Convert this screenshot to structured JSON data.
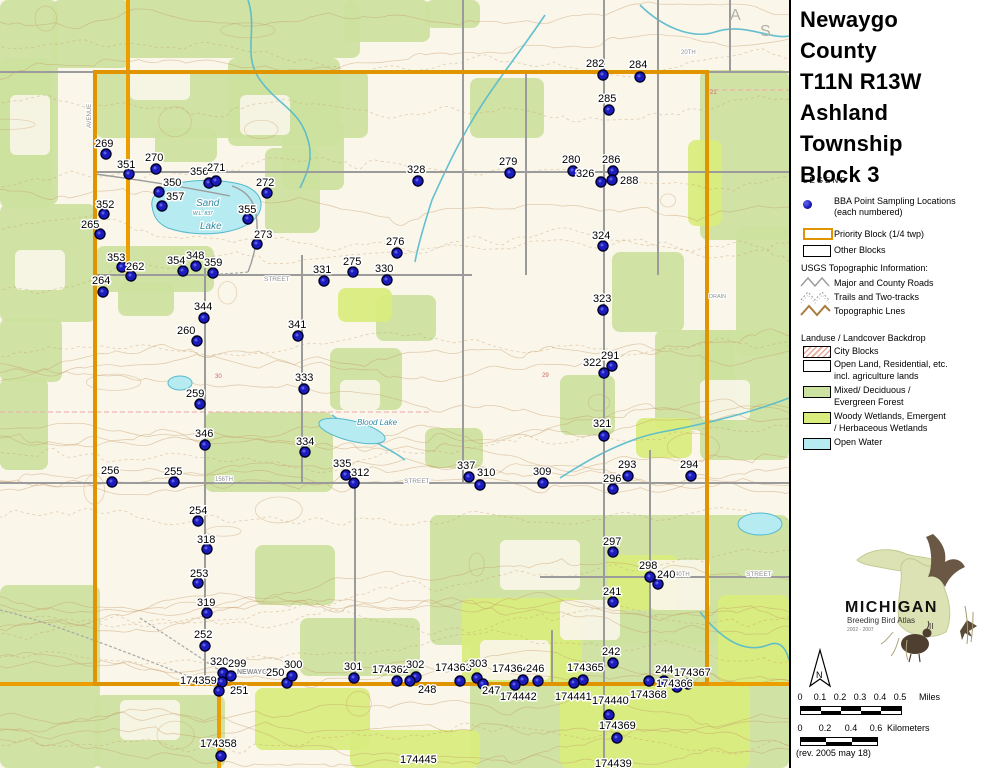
{
  "panel": {
    "title": "Newaygo\nCounty\nT11N R13W\nAshland\nTownship\nBlock 3",
    "legend_heading": "LEGEND",
    "legend": {
      "bba_line1": "BBA Point Sampling Locations",
      "bba_line2": "(each numbered)",
      "priority": "Priority Block (1/4 twp)",
      "other": "Other Blocks",
      "usgs_heading": "USGS Topographic Information:",
      "roads": "Major and County Roads",
      "trails": "Trails and Two-tracks",
      "topo": "Topographic Lnes",
      "landuse_heading": "Landuse / Landcover Backdrop",
      "city": "City Blocks",
      "open1": "Open Land, Residential, etc.",
      "open2": "incl. agriculture lands",
      "mixed1": "Mixed/ Deciduous /",
      "mixed2": "Evergreen Forest",
      "woody1": "Woody Wetlands, Emergent",
      "woody2": "/ Herbaceous Wetlands",
      "water": "Open Water"
    },
    "logo": {
      "name": "MICHIGAN",
      "subtitle": "Breeding Bird Atlas",
      "years": "2002 - 2007",
      "numeral": "II"
    },
    "north_label": "N",
    "scale_miles": {
      "labels": [
        "0",
        "0.1",
        "0.2",
        "0.3",
        "0.4",
        "0.5"
      ],
      "unit": "Miles"
    },
    "scale_km": {
      "labels": [
        "0",
        "0.2",
        "0.4",
        "0.6"
      ],
      "unit": "Kilometers"
    },
    "revision": "(rev. 2005 may 18)"
  },
  "colors": {
    "priority": "#df9400",
    "highway": "#ec9e00",
    "road": "#9b9b9b",
    "contour": "#c59a66",
    "forest": "#cde2a0",
    "wetland": "#d9ec7e",
    "water": "#b7ebf2",
    "water_edge": "#54b9cc",
    "dot_fill": "#1c1cbe",
    "dot_rim": "#00002a",
    "section_pink": "#eba8a8",
    "base": "#faf6ea"
  },
  "map": {
    "points": [
      {
        "n": "269",
        "x": 106,
        "y": 154,
        "lx": 95,
        "ly": 137
      },
      {
        "n": "351",
        "x": 129,
        "y": 174,
        "lx": 117,
        "ly": 158
      },
      {
        "n": "270",
        "x": 156,
        "y": 169,
        "lx": 145,
        "ly": 151
      },
      {
        "n": "356",
        "x": 209,
        "y": 183,
        "lx": 190,
        "ly": 165
      },
      {
        "n": "271",
        "x": 216,
        "y": 181,
        "lx": 207,
        "ly": 161
      },
      {
        "n": "272",
        "x": 267,
        "y": 193,
        "lx": 256,
        "ly": 176
      },
      {
        "n": "350",
        "x": 159,
        "y": 192,
        "lx": 163,
        "ly": 176
      },
      {
        "n": "357",
        "x": 162,
        "y": 206,
        "lx": 166,
        "ly": 190
      },
      {
        "n": "352",
        "x": 104,
        "y": 214,
        "lx": 96,
        "ly": 198
      },
      {
        "n": "265",
        "x": 100,
        "y": 234,
        "lx": 81,
        "ly": 218
      },
      {
        "n": "355",
        "x": 248,
        "y": 219,
        "lx": 238,
        "ly": 203
      },
      {
        "n": "273",
        "x": 257,
        "y": 244,
        "lx": 254,
        "ly": 228
      },
      {
        "n": "353",
        "x": 122,
        "y": 267,
        "lx": 107,
        "ly": 251
      },
      {
        "n": "262",
        "x": 131,
        "y": 276,
        "lx": 126,
        "ly": 260
      },
      {
        "n": "354",
        "x": 183,
        "y": 271,
        "lx": 167,
        "ly": 254
      },
      {
        "n": "348",
        "x": 196,
        "y": 266,
        "lx": 186,
        "ly": 249
      },
      {
        "n": "359",
        "x": 213,
        "y": 273,
        "lx": 204,
        "ly": 256
      },
      {
        "n": "264",
        "x": 103,
        "y": 292,
        "lx": 92,
        "ly": 274
      },
      {
        "n": "282",
        "x": 603,
        "y": 75,
        "lx": 586,
        "ly": 57
      },
      {
        "n": "284",
        "x": 640,
        "y": 77,
        "lx": 629,
        "ly": 58
      },
      {
        "n": "285",
        "x": 609,
        "y": 110,
        "lx": 598,
        "ly": 92
      },
      {
        "n": "279",
        "x": 510,
        "y": 173,
        "lx": 499,
        "ly": 155
      },
      {
        "n": "280",
        "x": 573,
        "y": 171,
        "lx": 562,
        "ly": 153
      },
      {
        "n": "286",
        "x": 613,
        "y": 171,
        "lx": 602,
        "ly": 153
      },
      {
        "n": "326",
        "x": 601,
        "y": 182,
        "lx": 576,
        "ly": 167
      },
      {
        "n": "288",
        "x": 612,
        "y": 180,
        "lx": 620,
        "ly": 174
      },
      {
        "n": "328",
        "x": 418,
        "y": 181,
        "lx": 407,
        "ly": 163
      },
      {
        "n": "324",
        "x": 603,
        "y": 246,
        "lx": 592,
        "ly": 229
      },
      {
        "n": "276",
        "x": 397,
        "y": 253,
        "lx": 386,
        "ly": 235
      },
      {
        "n": "331",
        "x": 324,
        "y": 281,
        "lx": 313,
        "ly": 263
      },
      {
        "n": "275",
        "x": 353,
        "y": 272,
        "lx": 343,
        "ly": 255
      },
      {
        "n": "330",
        "x": 387,
        "y": 280,
        "lx": 375,
        "ly": 262
      },
      {
        "n": "344",
        "x": 204,
        "y": 318,
        "lx": 194,
        "ly": 300
      },
      {
        "n": "260",
        "x": 197,
        "y": 341,
        "lx": 177,
        "ly": 324
      },
      {
        "n": "341",
        "x": 298,
        "y": 336,
        "lx": 288,
        "ly": 318
      },
      {
        "n": "323",
        "x": 603,
        "y": 310,
        "lx": 593,
        "ly": 292
      },
      {
        "n": "322",
        "x": 604,
        "y": 373,
        "lx": 583,
        "ly": 356
      },
      {
        "n": "291",
        "x": 612,
        "y": 366,
        "lx": 601,
        "ly": 349
      },
      {
        "n": "333",
        "x": 304,
        "y": 389,
        "lx": 295,
        "ly": 371
      },
      {
        "n": "259",
        "x": 200,
        "y": 404,
        "lx": 186,
        "ly": 387
      },
      {
        "n": "321",
        "x": 604,
        "y": 436,
        "lx": 593,
        "ly": 417
      },
      {
        "n": "346",
        "x": 205,
        "y": 445,
        "lx": 195,
        "ly": 427
      },
      {
        "n": "334",
        "x": 305,
        "y": 452,
        "lx": 296,
        "ly": 435
      },
      {
        "n": "256",
        "x": 112,
        "y": 482,
        "lx": 101,
        "ly": 464
      },
      {
        "n": "255",
        "x": 174,
        "y": 482,
        "lx": 164,
        "ly": 465
      },
      {
        "n": "335",
        "x": 346,
        "y": 475,
        "lx": 333,
        "ly": 457
      },
      {
        "n": "312",
        "x": 354,
        "y": 483,
        "lx": 351,
        "ly": 466
      },
      {
        "n": "337",
        "x": 469,
        "y": 477,
        "lx": 457,
        "ly": 459
      },
      {
        "n": "310",
        "x": 480,
        "y": 485,
        "lx": 477,
        "ly": 466
      },
      {
        "n": "309",
        "x": 543,
        "y": 483,
        "lx": 533,
        "ly": 465
      },
      {
        "n": "293",
        "x": 628,
        "y": 476,
        "lx": 618,
        "ly": 458
      },
      {
        "n": "296",
        "x": 613,
        "y": 489,
        "lx": 603,
        "ly": 472
      },
      {
        "n": "294",
        "x": 691,
        "y": 476,
        "lx": 680,
        "ly": 458
      },
      {
        "n": "254",
        "x": 198,
        "y": 521,
        "lx": 189,
        "ly": 504
      },
      {
        "n": "318",
        "x": 207,
        "y": 549,
        "lx": 197,
        "ly": 533
      },
      {
        "n": "253",
        "x": 198,
        "y": 583,
        "lx": 190,
        "ly": 567
      },
      {
        "n": "319",
        "x": 207,
        "y": 613,
        "lx": 197,
        "ly": 596
      },
      {
        "n": "297",
        "x": 613,
        "y": 552,
        "lx": 603,
        "ly": 535
      },
      {
        "n": "298",
        "x": 650,
        "y": 577,
        "lx": 639,
        "ly": 559
      },
      {
        "n": "240",
        "x": 658,
        "y": 584,
        "lx": 657,
        "ly": 568
      },
      {
        "n": "241",
        "x": 613,
        "y": 602,
        "lx": 603,
        "ly": 585
      },
      {
        "n": "252",
        "x": 205,
        "y": 646,
        "lx": 194,
        "ly": 628
      },
      {
        "n": "320",
        "x": 223,
        "y": 673,
        "lx": 210,
        "ly": 655
      },
      {
        "n": "299",
        "x": 231,
        "y": 676,
        "lx": 228,
        "ly": 657
      },
      {
        "n": "174359",
        "x": 222,
        "y": 682,
        "lx": 180,
        "ly": 674
      },
      {
        "n": "251",
        "x": 219,
        "y": 691,
        "lx": 230,
        "ly": 684
      },
      {
        "n": "250",
        "x": 287,
        "y": 683,
        "lx": 266,
        "ly": 666
      },
      {
        "n": "300",
        "x": 292,
        "y": 676,
        "lx": 284,
        "ly": 658
      },
      {
        "n": "301",
        "x": 354,
        "y": 678,
        "lx": 344,
        "ly": 660
      },
      {
        "n": "174362",
        "x": 397,
        "y": 681,
        "lx": 372,
        "ly": 663
      },
      {
        "n": "302",
        "x": 416,
        "y": 677,
        "lx": 406,
        "ly": 658
      },
      {
        "n": "248",
        "x": 410,
        "y": 681,
        "lx": 418,
        "ly": 683
      },
      {
        "n": "174363",
        "x": 460,
        "y": 681,
        "lx": 435,
        "ly": 661
      },
      {
        "n": "303",
        "x": 477,
        "y": 678,
        "lx": 469,
        "ly": 657
      },
      {
        "n": "247",
        "x": 483,
        "y": 684,
        "lx": 482,
        "ly": 684
      },
      {
        "n": "174364",
        "x": 523,
        "y": 680,
        "lx": 492,
        "ly": 662
      },
      {
        "n": "246",
        "x": 538,
        "y": 681,
        "lx": 526,
        "ly": 662
      },
      {
        "n": "174442",
        "x": 515,
        "y": 685,
        "lx": 500,
        "ly": 690
      },
      {
        "n": "174365",
        "x": 583,
        "y": 680,
        "lx": 567,
        "ly": 661
      },
      {
        "n": "174441",
        "x": 574,
        "y": 683,
        "lx": 555,
        "ly": 690
      },
      {
        "n": "242",
        "x": 613,
        "y": 663,
        "lx": 602,
        "ly": 645
      },
      {
        "n": "174440",
        "x": 609,
        "y": 715,
        "lx": 592,
        "ly": 694
      },
      {
        "n": "174369",
        "x": 617,
        "y": 738,
        "lx": 599,
        "ly": 719
      },
      {
        "n": "244",
        "x": 649,
        "y": 681,
        "lx": 655,
        "ly": 663
      },
      {
        "n": "174367",
        "x": 664,
        "y": 681,
        "lx": 674,
        "ly": 666
      },
      {
        "n": "174366",
        "x": 688,
        "y": 684,
        "lx": 656,
        "ly": 677
      },
      {
        "n": "174368",
        "x": 677,
        "y": 687,
        "lx": 630,
        "ly": 688
      },
      {
        "n": "174358",
        "x": 221,
        "y": 756,
        "lx": 200,
        "ly": 737
      },
      {
        "n": "174445",
        "lx": 400,
        "ly": 753,
        "nodot": true
      },
      {
        "n": "174439",
        "lx": 595,
        "ly": 757,
        "nodot": true
      }
    ],
    "street_labels": [
      {
        "t": "NEWAYGO",
        "x": 237,
        "y": 674,
        "s": 7,
        "b": 1
      },
      {
        "t": "STREET",
        "x": 264,
        "y": 281,
        "s": 6.5
      },
      {
        "t": "STREET",
        "x": 404,
        "y": 483,
        "s": 6.5
      },
      {
        "t": "156TH",
        "x": 215,
        "y": 481,
        "s": 6
      },
      {
        "t": "STREET",
        "x": 746,
        "y": 576,
        "s": 6.5
      },
      {
        "t": "40TH",
        "x": 675,
        "y": 576,
        "s": 6
      },
      {
        "t": "20TH",
        "x": 681,
        "y": 54,
        "s": 6
      },
      {
        "t": "DRAIN",
        "x": 709,
        "y": 298,
        "s": 5.5
      },
      {
        "t": "AVENUE",
        "x": 91,
        "y": 128,
        "s": 6,
        "rot": -90
      }
    ],
    "water_labels": [
      {
        "t": "Sand",
        "x": 196,
        "y": 206,
        "s": 10
      },
      {
        "t": "W.L. 837",
        "x": 193,
        "y": 215,
        "s": 5
      },
      {
        "t": "Lake",
        "x": 200,
        "y": 229,
        "s": 10
      },
      {
        "t": "Blood Lake",
        "x": 357,
        "y": 425,
        "s": 8
      }
    ],
    "section_numbers": [
      {
        "t": "30",
        "x": 215,
        "y": 378
      },
      {
        "t": "29",
        "x": 542,
        "y": 377
      },
      {
        "t": "21",
        "x": 710,
        "y": 94
      }
    ],
    "watermarks": [
      {
        "t": "A",
        "x": 730,
        "y": 20
      },
      {
        "t": "S",
        "x": 760,
        "y": 36
      }
    ]
  }
}
